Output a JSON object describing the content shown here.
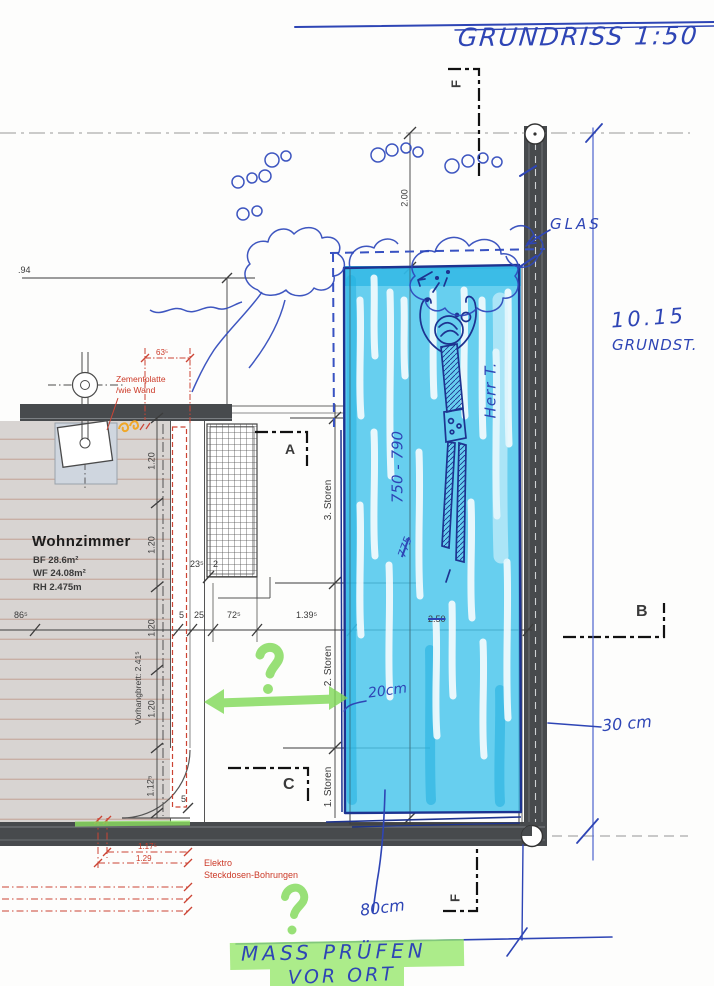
{
  "sheet": {
    "title": "GRUNDRISS 1:50"
  },
  "room": {
    "name": "Wohnzimmer",
    "bf": "BF  28.6m²",
    "wf": "WF  24.08m²",
    "rh": "RH  2.475m"
  },
  "sections": {
    "f_top": "F",
    "f_bottom": "F",
    "a": "A",
    "b": "B",
    "c": "C"
  },
  "storen": {
    "s3": "3. Storen",
    "s2": "2. Storen",
    "s1": "1. Storen"
  },
  "dims": {
    "d94": ".94",
    "d200": "2.00",
    "d120": "1.20",
    "d1125": "1.12⁵",
    "d5door": "5",
    "d865": "86⁵",
    "d5": "5",
    "d25": "25",
    "d725": "72⁵",
    "d1395": "1.39⁵",
    "d250": "2.50",
    "d235": "23⁵",
    "d2": "2",
    "vorhangbrett": "Vorhangbrett: 2.41⁵"
  },
  "red_notes": {
    "zem1": "Zementplatte",
    "zem2": "/wie Wand",
    "d635": "63⁵",
    "elektro1": "Elektro",
    "elektro2": "Steckdosen-Bohrungen",
    "d1175": "1.17⁵",
    "d129": "1.29"
  },
  "hand": {
    "glas": "GLAS",
    "plot_value": "10.15",
    "plot_label": "GRUNDST.",
    "herr": "Herr T.",
    "range": "750 - 790",
    "struck": "775",
    "c20": "20cm",
    "c30": "30 cm",
    "c80": "80cm",
    "note1": "MASS PRÜFEN",
    "note2": "VOR ORT"
  },
  "colors": {
    "pen_blue": "#2e45b5",
    "navy_pen": "#1d3390",
    "marker_cyan": "#45c5eb",
    "highlighter_green": "#8ce060",
    "cad_red": "#cc3a28",
    "wall_gray": "#474a4d",
    "floor_gray": "#d8d4d2"
  }
}
